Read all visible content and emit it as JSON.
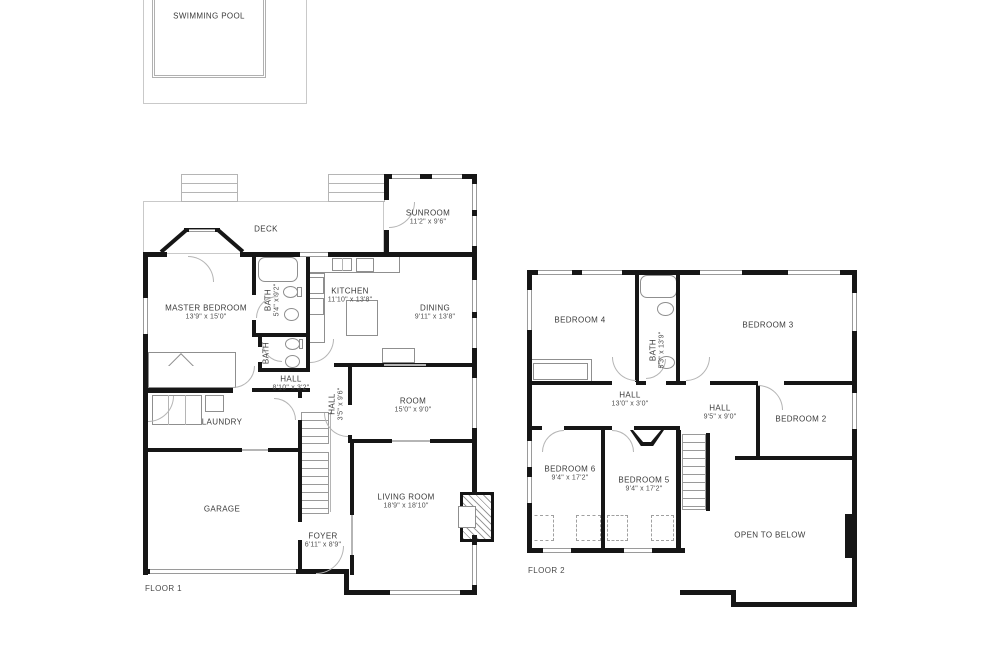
{
  "pool": {
    "label": "SWIMMING POOL"
  },
  "floor1": {
    "name": "FLOOR 1",
    "rooms": {
      "deck": {
        "label": "DECK"
      },
      "sunroom": {
        "label": "SUNROOM",
        "dims": "11'2\" x 9'6\""
      },
      "master": {
        "label": "MASTER BEDROOM",
        "dims": "13'9\" x 15'0\""
      },
      "bath1": {
        "label": "BATH",
        "dims": "5'4\" x 9'2\""
      },
      "bath2": {
        "label": "BATH"
      },
      "kitchen": {
        "label": "KITCHEN",
        "dims": "11'10\" x 13'8\""
      },
      "dining": {
        "label": "DINING",
        "dims": "9'11\" x 13'8\""
      },
      "hall1": {
        "label": "HALL",
        "dims": "8'10\" x 3'2\""
      },
      "hall2": {
        "label": "HALL",
        "dims": "3'5\" x 9'6\""
      },
      "room": {
        "label": "ROOM",
        "dims": "15'0\" x 9'0\""
      },
      "laundry": {
        "label": "LAUNDRY"
      },
      "garage": {
        "label": "GARAGE"
      },
      "living": {
        "label": "LIVING ROOM",
        "dims": "18'9\" x 18'10\""
      },
      "foyer": {
        "label": "FOYER",
        "dims": "6'11\" x 8'9\""
      }
    }
  },
  "floor2": {
    "name": "FLOOR 2",
    "rooms": {
      "bedroom4": {
        "label": "BEDROOM 4"
      },
      "bath": {
        "label": "BATH",
        "dims": "5'3\" x 13'9\""
      },
      "bedroom3": {
        "label": "BEDROOM 3"
      },
      "hall_upper": {
        "label": "HALL",
        "dims": "13'0\" x 3'0\""
      },
      "hall_lower": {
        "label": "HALL",
        "dims": "9'5\" x 9'0\""
      },
      "bedroom2": {
        "label": "BEDROOM 2"
      },
      "bedroom6": {
        "label": "BEDROOM 6",
        "dims": "9'4\" x 17'2\""
      },
      "bedroom5": {
        "label": "BEDROOM 5",
        "dims": "9'4\" x 17'2\""
      },
      "open_below": {
        "label": "OPEN TO BELOW"
      }
    }
  },
  "colors": {
    "wall": "#161616",
    "fixture": "#8f8f8f",
    "outline": "#c9c9c9",
    "text": "#3a3a3a"
  }
}
